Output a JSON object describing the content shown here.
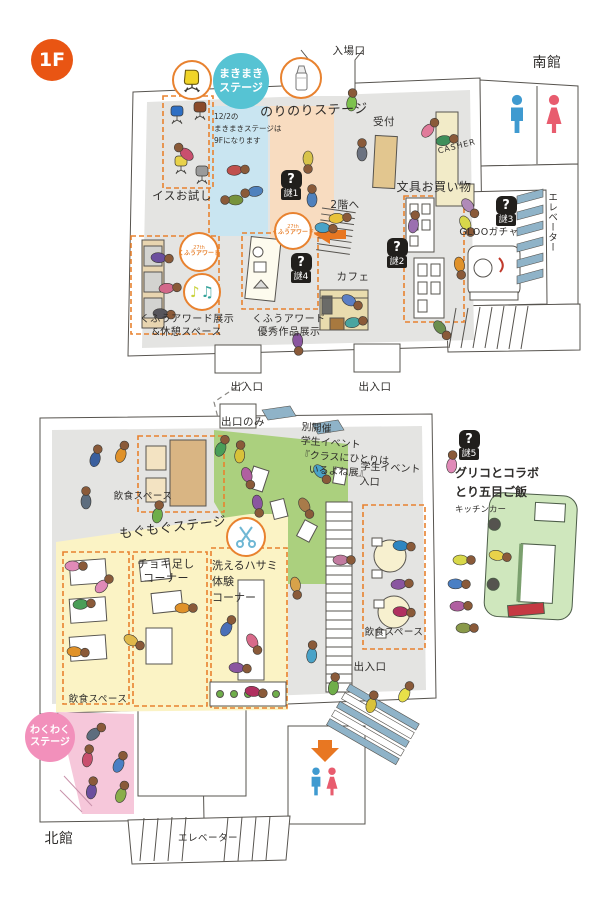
{
  "floor_badge": "1F",
  "south": {
    "name": "南館",
    "entrance": "入場口",
    "makimaki_stage": {
      "line1": "まきまき",
      "line2": "ステージ"
    },
    "norinori_stage": "のりのりステージ",
    "notice": {
      "line1": "12/2の",
      "line2": "まきまきステージは",
      "line3": "9Fになります"
    },
    "chair_trial": "イスお試し",
    "reception": "受付",
    "casher": "CASHER",
    "stationery": "文具お買い物",
    "to_2f": "2階へ",
    "cafe": "カフェ",
    "gloo_gacha": "GLOOガチャ",
    "elevator": "エレベーター",
    "kufu_badge": {
      "top": "27th",
      "main": "くふうアワード"
    },
    "kufu_exhibit": {
      "line1": "くふうアワード展示",
      "line2": "&休憩スペース"
    },
    "kufu_excellent": {
      "line1": "くふうアワード",
      "line2": "優秀作品展示"
    },
    "exit_inout": "出入口"
  },
  "north": {
    "name": "北館",
    "exit_only": "出口のみ",
    "student_event": {
      "line1": "別開催",
      "line2": "学生イベント",
      "line3": "『クラスにひとりは",
      "line4": "いるよね展』"
    },
    "student_entrance": {
      "line1": "学生イベント",
      "line2": "入口"
    },
    "glico": {
      "line1": "グリコとコラボ",
      "line2": "とり五目ご飯",
      "sub": "キッチンカー"
    },
    "eat_space": "飲食スペース",
    "mogumogu_stage": "もぐもぐステージ",
    "wakuwaku_stage": {
      "line1": "わくわく",
      "line2": "ステージ"
    },
    "choki": {
      "line1": "チョキ足し",
      "line2": "コーナー"
    },
    "scissors_corner": {
      "line1": "洗えるハサミ",
      "line2": "体験",
      "line3": "コーナー"
    },
    "exit_inout": "出入口",
    "elevator": "エレベーター"
  },
  "riddles": [
    {
      "q": "?",
      "label": "謎1"
    },
    {
      "q": "?",
      "label": "謎2"
    },
    {
      "q": "?",
      "label": "謎3"
    },
    {
      "q": "?",
      "label": "謎4"
    },
    {
      "q": "?",
      "label": "謎5"
    }
  ],
  "icons": {
    "music1": "♪",
    "music2": "♫"
  },
  "colors": {
    "accent_orange": "#e95513",
    "dashed_box_orange": "#e8822f",
    "stage_cyan": "#56c3d3",
    "stage_pink": "#f290bb",
    "zone_yellow": "#fbf3c5",
    "zone_green": "#abd07e",
    "zone_pink": "#f6c7da",
    "zone_blue": "#c9e5f1",
    "zone_peach": "#f8dcc0",
    "floor_gray": "#e4e4e2",
    "riddle_black": "#211f1c",
    "wc_male_blue": "#3f9ad0",
    "wc_female_red": "#e85c6e"
  }
}
